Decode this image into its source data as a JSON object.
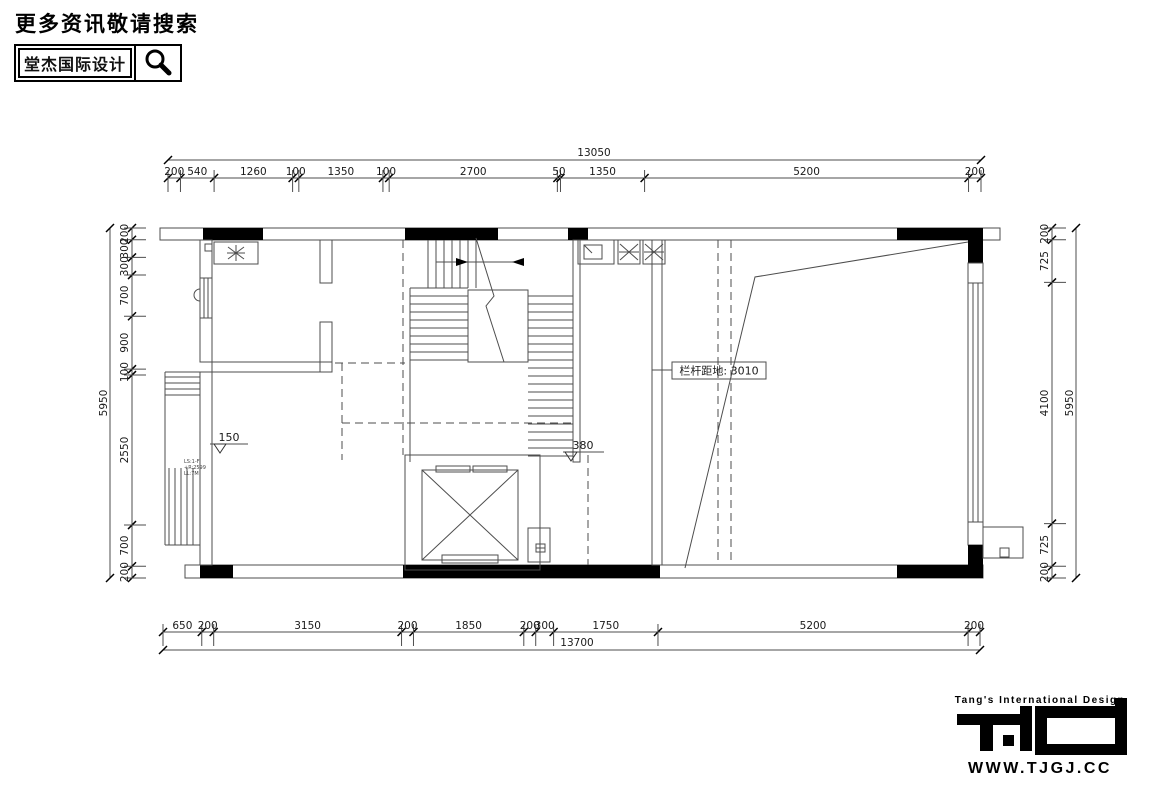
{
  "header": {
    "tagline": "更多资讯敬请搜索",
    "brand": "堂杰国际设计"
  },
  "footer": {
    "tagline": "Tang's International Design",
    "website": "WWW.TJGJ.CC"
  },
  "plan": {
    "annotations": {
      "railing_label": "栏杆距地: 3010",
      "level_a": "150",
      "level_b": "380",
      "note_lines": [
        "LS:1-F",
        "+R:2599",
        "LL:7M"
      ]
    },
    "dimensions": {
      "top": {
        "total": "13050",
        "segments": [
          200,
          540,
          1260,
          100,
          1350,
          100,
          2700,
          50,
          1350,
          5200,
          200
        ]
      },
      "bottom": {
        "total": "13700",
        "segments": [
          650,
          200,
          3150,
          200,
          1850,
          200,
          300,
          1750,
          5200,
          200
        ]
      },
      "left": {
        "total": "5950",
        "segments": [
          200,
          300,
          300,
          700,
          900,
          100,
          2550,
          700,
          200
        ]
      },
      "right": {
        "total": "5950",
        "segments": [
          200,
          725,
          4100,
          725,
          200
        ]
      }
    }
  }
}
